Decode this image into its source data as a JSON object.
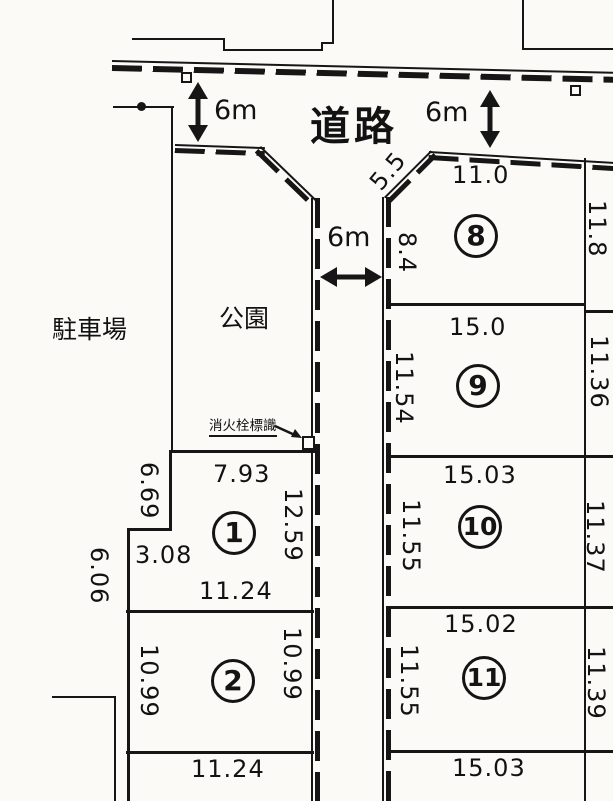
{
  "areas": {
    "road_label": "道路",
    "parking_label": "駐車場",
    "park_label": "公園"
  },
  "annotations": {
    "fire_hydrant_sign_label": "消火栓標識",
    "road_width_left": "6m",
    "road_width_right": "6m",
    "street_width": "6m",
    "corner_cut_length": "5.5"
  },
  "plots": {
    "p1": {
      "number": "1",
      "top": "7.93",
      "left_upper": "6.69",
      "left_step": "3.08",
      "left_lower": "6.06",
      "right": "12.59",
      "bottom": "11.24"
    },
    "p2": {
      "number": "2",
      "left": "10.99",
      "right": "10.99",
      "bottom": "11.24"
    },
    "p8": {
      "number": "8",
      "top": "11.0",
      "left": "8.4",
      "right": "11.8",
      "bottom": "15.0"
    },
    "p9": {
      "number": "9",
      "left": "11.54",
      "right": "11.36",
      "bottom": "15.03"
    },
    "p10": {
      "number": "10",
      "left": "11.55",
      "right": "11.37",
      "bottom": "15.02"
    },
    "p11": {
      "number": "11",
      "left": "11.55",
      "right": "11.39",
      "bottom": "15.03"
    }
  }
}
